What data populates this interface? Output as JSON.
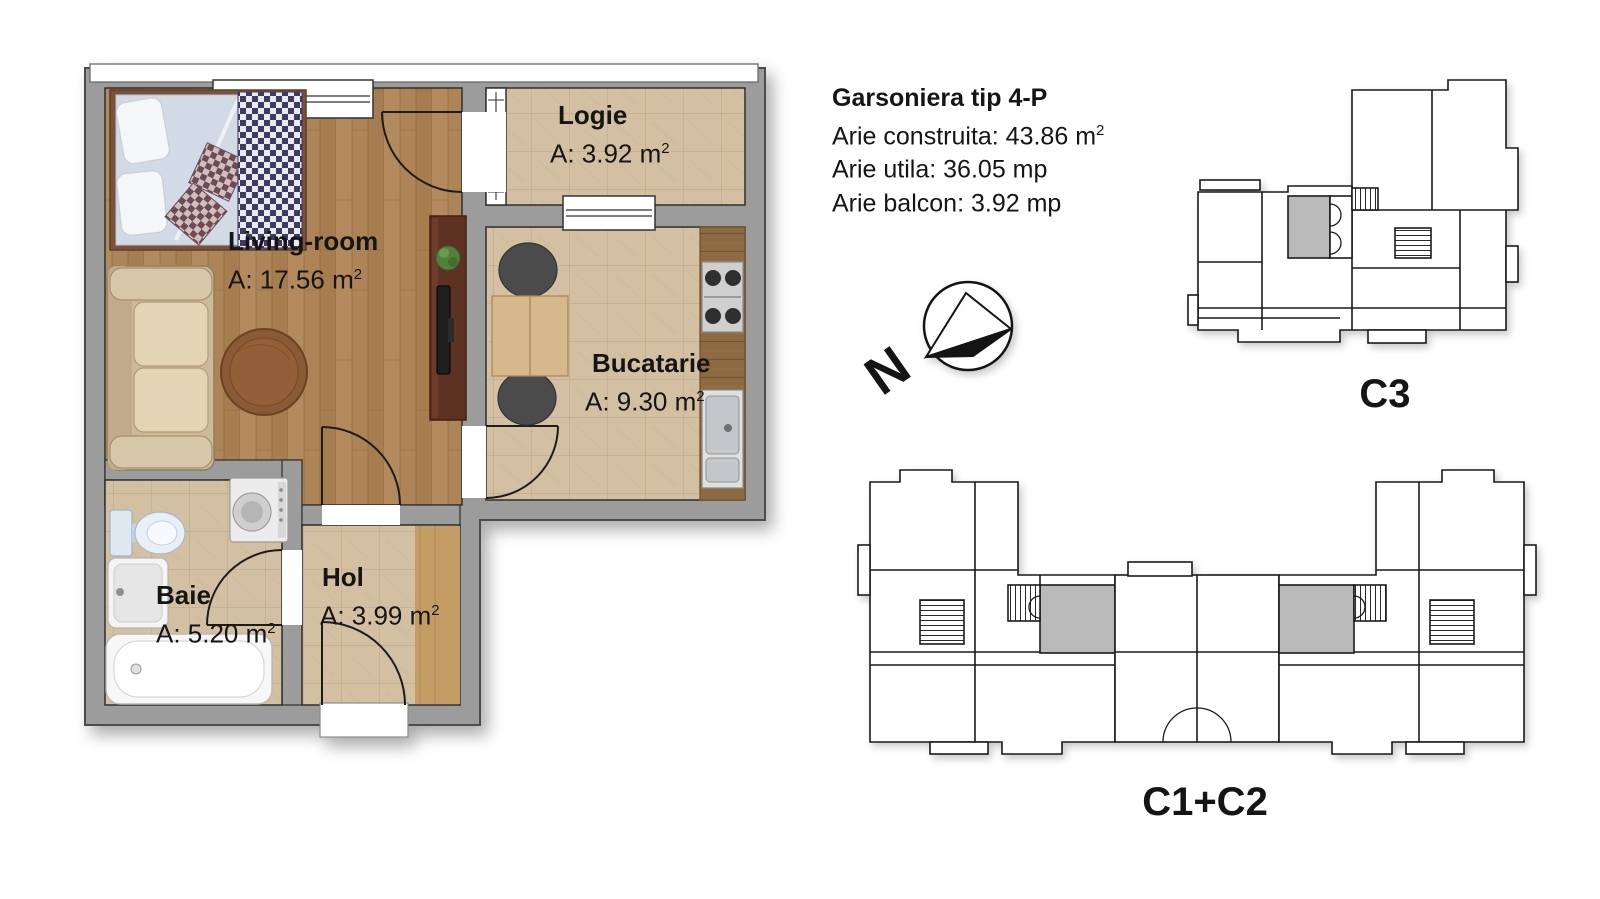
{
  "info_block": {
    "title": "Garsoniera tip 4-P",
    "lines": [
      {
        "text": "Arie construita: 43.86 m",
        "sup": "2"
      },
      {
        "text": "Arie utila: 36.05 mp",
        "sup": ""
      },
      {
        "text": "Arie balcon: 3.92 mp",
        "sup": ""
      }
    ]
  },
  "rooms": [
    {
      "id": "living",
      "name": "Living-room",
      "area": "A: 17.56 m",
      "sup": "2"
    },
    {
      "id": "logie",
      "name": "Logie",
      "area": "A: 3.92 m",
      "sup": "2"
    },
    {
      "id": "bucatarie",
      "name": "Bucatarie",
      "area": "A: 9.30 m",
      "sup": "2"
    },
    {
      "id": "baie",
      "name": "Baie",
      "area": "A: 5.20 m",
      "sup": "2"
    },
    {
      "id": "hol",
      "name": "Hol",
      "area": "A: 3.99 m",
      "sup": "2"
    }
  ],
  "key_plans": [
    {
      "label": "C3"
    },
    {
      "label": "C1+C2"
    }
  ],
  "compass": {
    "label": "N"
  },
  "colors": {
    "wall": "#9c9c9c",
    "wood_floor": "#ad8458",
    "tile_floor": "#d3c0a3",
    "hol_wood": "#c49d66",
    "counter_wood": "#8d6a42",
    "tv_stand": "#5d3222",
    "highlight_unit": "#b9b9b9"
  }
}
